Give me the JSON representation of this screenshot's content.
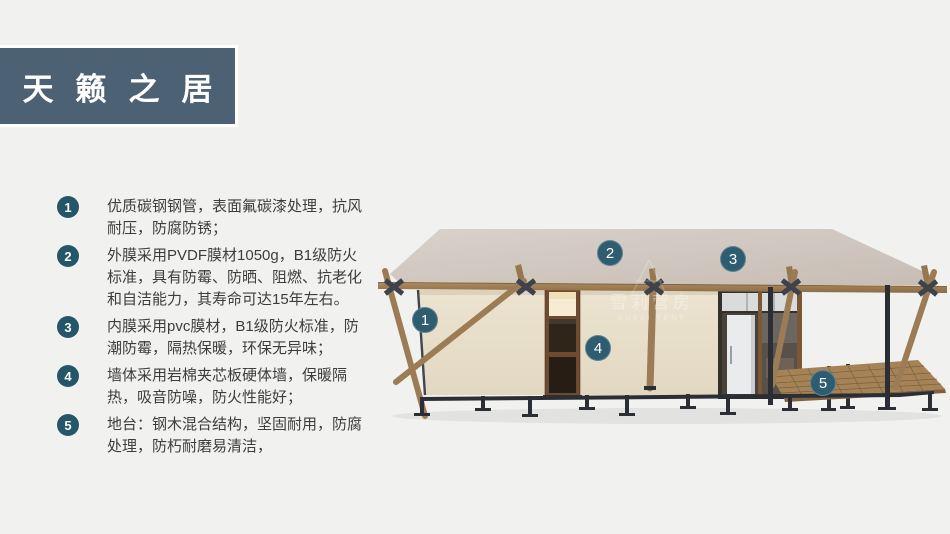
{
  "slide": {
    "background_color": "#f1f1ef"
  },
  "title": {
    "text": "天籁之居",
    "background_color": "#4c6173",
    "text_color": "#ffffff"
  },
  "features": [
    {
      "num": "1",
      "text": "优质碳钢钢管，表面氟碳漆处理，抗风耐压，防腐防锈；"
    },
    {
      "num": "2",
      "text": "外膜采用PVDF膜材1050g，B1级防火标准，具有防霉、防晒、阻燃、抗老化和自洁能力，其寿命可达15年左右。"
    },
    {
      "num": "3",
      "text": "内膜采用pvc膜材，B1级防火标准，防潮防霉，隔热保暖，环保无异味；"
    },
    {
      "num": "4",
      "text": "墙体采用岩棉夹芯板硬体墙，保暖隔热，吸音防噪，防火性能好；"
    },
    {
      "num": "5",
      "text": "地台：钢木混合结构，坚固耐用，防腐处理，防朽耐磨易清洁，"
    }
  ],
  "diagram": {
    "marker_color": "#2e5c70",
    "bullet_color": "#255569",
    "markers": [
      {
        "num": "1"
      },
      {
        "num": "2"
      },
      {
        "num": "3"
      },
      {
        "num": "4"
      },
      {
        "num": "5"
      }
    ],
    "watermark": {
      "cn": "雪莉营房",
      "en": "XUELI TENT"
    }
  }
}
